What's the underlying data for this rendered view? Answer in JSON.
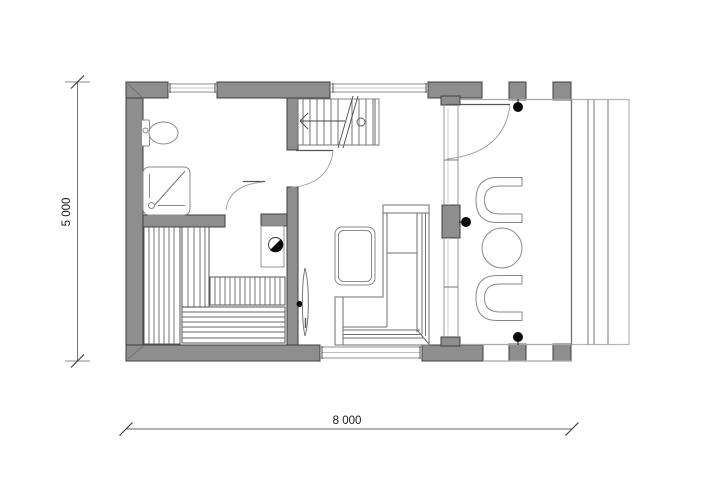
{
  "drawing": {
    "type": "architectural-floor-plan",
    "dims": {
      "height_label": "5 000",
      "width_label": "8 000"
    },
    "colors": {
      "background": "#ffffff",
      "wall_fill": "#8e8e8e",
      "wall_outline": "#3f3f3f",
      "thin_line": "#8a8a8a",
      "medium_line": "#666666",
      "terrace_line": "#a8a8a8",
      "dot": "#0a0a0a"
    },
    "fixtures": [
      "toilet",
      "shower-tray",
      "sauna-bench-left",
      "sauna-bench-mid",
      "sauna-bench-upper",
      "sauna-bench-lower",
      "sauna-stove",
      "sauna-glass-door",
      "staircase",
      "bathroom-door",
      "hall-door",
      "entrance-door",
      "glass-wall",
      "sofa-l-shaped",
      "coffee-table",
      "terrace-chair-top",
      "terrace-chair-bottom",
      "terrace-round-table",
      "terrace-deck",
      "posts"
    ]
  }
}
